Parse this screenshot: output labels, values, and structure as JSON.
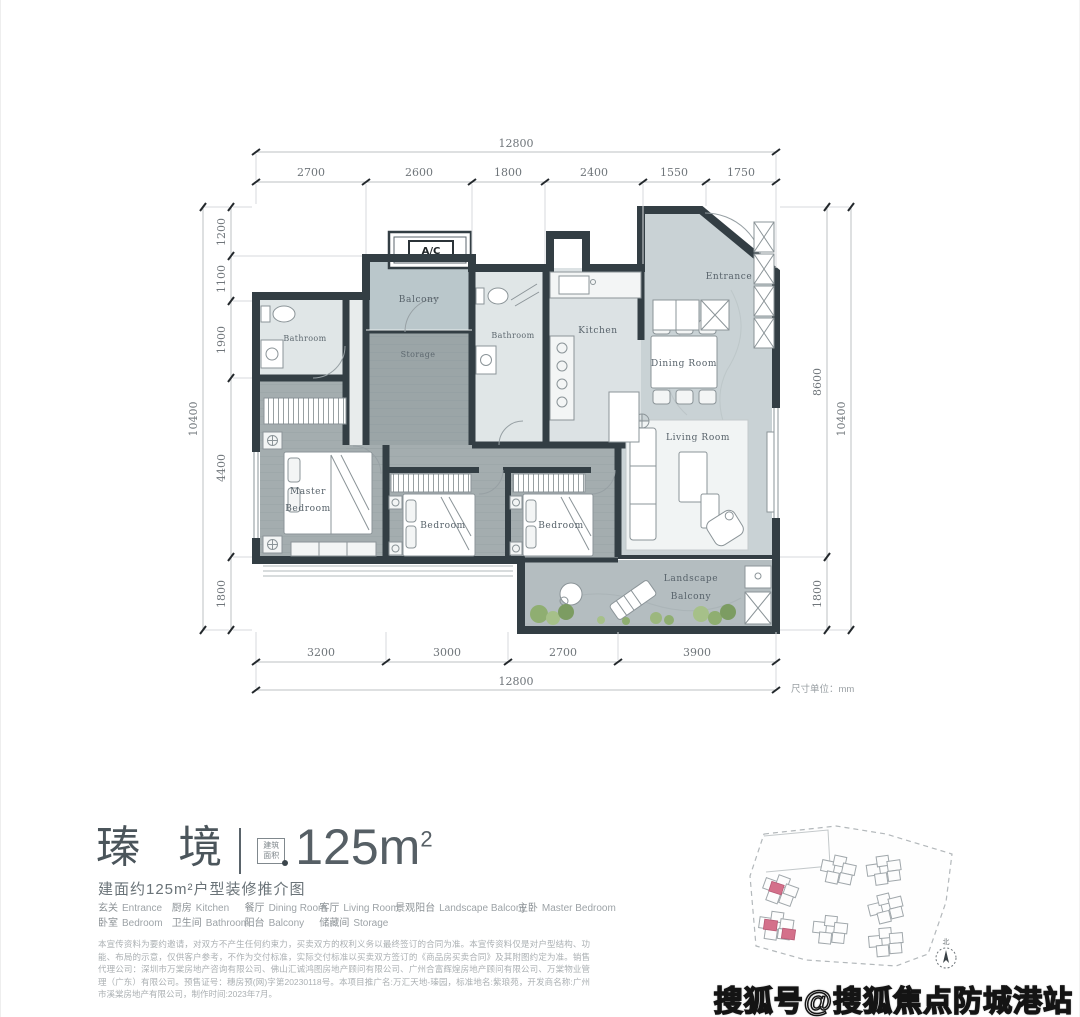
{
  "plan": {
    "ac_label": "A/C",
    "rooms": {
      "bathroom_left": "Bathroom",
      "balcony_top": "Balcony",
      "storage": "Storage",
      "bathroom_mid": "Bathroom",
      "kitchen": "Kitchen",
      "dining": "Dining Room",
      "entrance": "Entrance",
      "living": "Living Room",
      "master_l1": "Master",
      "master_l2": "Bedroom",
      "bedroom_mid": "Bedroom",
      "bedroom_right": "Bedroom",
      "landscape_l1": "Landscape",
      "landscape_l2": "Balcony"
    },
    "dims": {
      "unit_note": "尺寸单位：mm",
      "top_total": "12800",
      "top_segments": [
        "2700",
        "2600",
        "1800",
        "2400",
        "1550",
        "1750"
      ],
      "bottom_total": "12800",
      "bottom_segments": [
        "3200",
        "3000",
        "2700",
        "3900"
      ],
      "left_total": "10400",
      "left_segments": [
        "1200",
        "1100",
        "1900",
        "4400",
        "1800"
      ],
      "right_segments": [
        "8600",
        "1800"
      ],
      "right_total": "10400"
    }
  },
  "info": {
    "title": "瑧 境",
    "badge_line1": "建筑",
    "badge_line2": "面积",
    "area": "125m",
    "area_sup": "2",
    "subtitle": "建面约125m²户型装修推介图",
    "legend_row1": [
      {
        "zh": "玄关",
        "en": "Entrance"
      },
      {
        "zh": "厨房",
        "en": "Kitchen"
      },
      {
        "zh": "餐厅",
        "en": "Dining Room"
      },
      {
        "zh": "客厅",
        "en": "Living Room"
      },
      {
        "zh": "景观阳台",
        "en": "Landscape Balcony"
      },
      {
        "zh": "主卧",
        "en": "Master Bedroom"
      }
    ],
    "legend_row2": [
      {
        "zh": "卧室",
        "en": "Bedroom"
      },
      {
        "zh": "卫生间",
        "en": "Bathroom"
      },
      {
        "zh": "阳台",
        "en": "Balcony"
      },
      {
        "zh": "储藏间",
        "en": "Storage"
      }
    ],
    "disclaimer": "本宣传资料为要约邀请，对双方不产生任何约束力，买卖双方的权利义务以最终签订的合同为准。本宣传资料仅是对户型结构、功能、布局的示意，仅供客户参考，不作为交付标准，实际交付标准以买卖双方签订的《商品房买卖合同》及其附图约定为准。销售代理公司：深圳市万棠房地产咨询有限公司、佛山汇诚鸿图房地产顾问有限公司、广州合富辉煌房地产顾问有限公司、万棠物业管理（广东）有限公司。预售证号：穗房预(网)字第20230118号。本项目推广名:万汇天地-瑧园，标准地名:紫琅苑，开发商名称:广州市溪棠房地产有限公司，制作时间:2023年7月。"
  },
  "sitemap": {
    "north_label": "北"
  },
  "watermark": "搜狐号@搜狐焦点防城港站",
  "colors": {
    "wall": "#333e44",
    "marble_floor": "#c9d2d5",
    "wood_floor": "#a4adaf",
    "balcony_floor": "#bac7cb",
    "highlight_pink": "#d4708a",
    "plant_green": "#8fae71"
  }
}
